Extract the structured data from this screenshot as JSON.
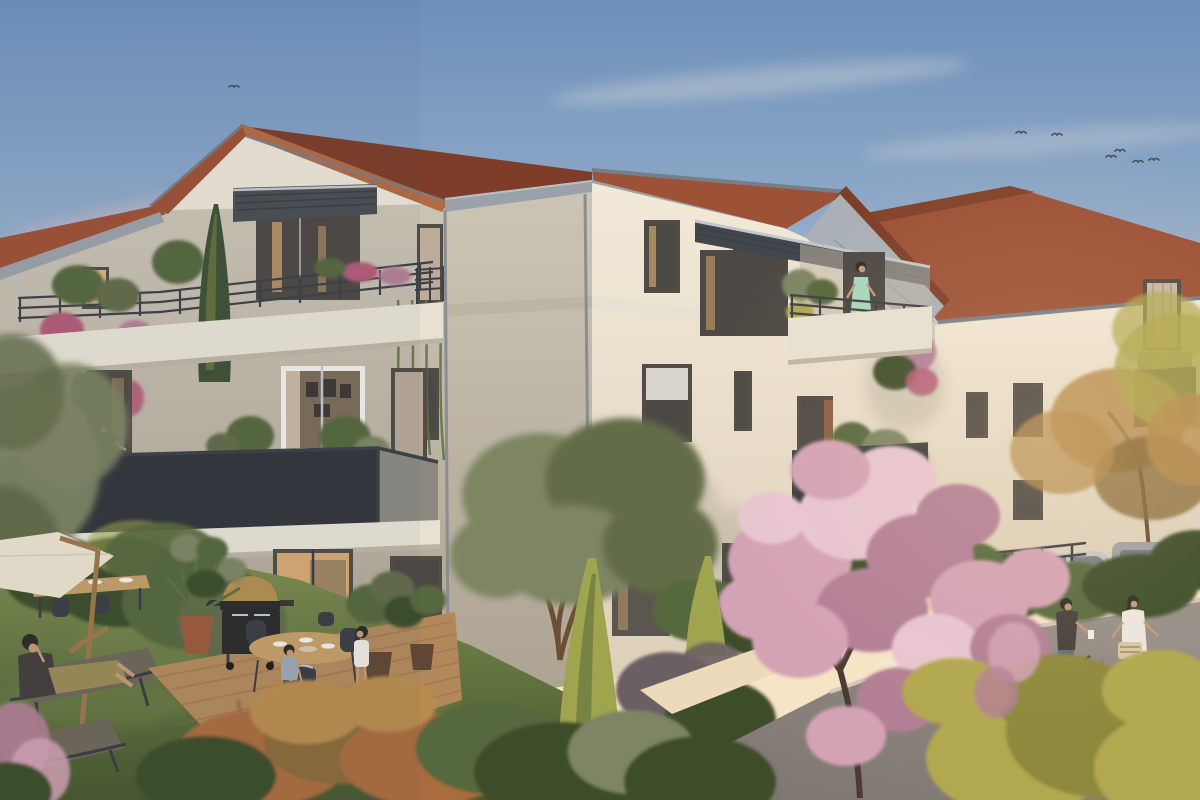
{
  "image": {
    "kind": "photorealistic architectural exterior rendering",
    "time_of_day": "dusk",
    "width_px": 1200,
    "height_px": 800
  },
  "palette": {
    "skyTop": "#6c90ba",
    "skyUpper": "#8fa9c7",
    "skyMid": "#bcc4ce",
    "skyLow": "#ead6c2",
    "skyHorizon": "#f7e3c6",
    "glowWarm": "#f8ddb0",
    "cloudPink": "#d8b9bd",
    "cloudWhite": "#e9e2dd",
    "birdGray": "#4a4f55",
    "roofTile": "#9d5136",
    "roofTileLight": "#b26a42",
    "roofTileDark": "#7d3d28",
    "fascia": "#9ba1a8",
    "fasciaDark": "#787e86",
    "soffit": "#a9b0b6",
    "alu": "#c2c7cc",
    "gableWhite": "#ebe4d5",
    "facadeFront": "#cfc8b9",
    "facadeFrontDark": "#ada392",
    "facadeSun": "#f2e9d8",
    "facadeSunLow": "#ddd0ba",
    "slab": "#e7e1d3",
    "slabShadow": "#bdb5a4",
    "railDark": "#3d4045",
    "mesh": "#33363a",
    "meshSun": "#8b8880",
    "winFrame": "#504c46",
    "glassCool": "#b0bac0",
    "glassDark": "#4c4843",
    "glassWarm": "#e3b276",
    "glassInterior": "#7c6c58",
    "curtain": "#c9b7a2",
    "shutter": "#8a6040",
    "grassLight": "#7d8e4f",
    "grassDark": "#47572e",
    "hedge": "#56673c",
    "hedgeDark": "#3e4d2b",
    "olive": "#7d8562",
    "oliveDark": "#636c49",
    "purpleShrub": "#6b5f63",
    "cypress": "#3f5234",
    "cypressGold": "#9fa44e",
    "blossom": "#d4a2b5",
    "blossomLight": "#e8c5d1",
    "blossomDark": "#b37f96",
    "blossomTrunk": "#4b3b33",
    "bougainvillea": "#b25c78",
    "goldenBush": "#b2a850",
    "goldenDark": "#8e893d",
    "autumn": "#b78c4d",
    "autumnDark": "#8a6a38",
    "orangeShrub": "#a96c3e",
    "deckWood": "#b2885a",
    "deckDark": "#8f6c42",
    "tableWood": "#c49e68",
    "road": "#968e88",
    "roadDark": "#7b746e",
    "curb": "#d2c9ba",
    "pathWarm": "#ecdabb",
    "lineWhite": "#eceae3",
    "carSilver": "#c6c6c7",
    "carGray": "#9da1a4",
    "carDark": "#686c70",
    "bikeRed": "#c23a33",
    "bikeDark": "#393c40",
    "basket": "#d8c8a6",
    "parasol": "#eae1cd",
    "woodPole": "#9c7749",
    "skin": "#c69876",
    "hairDark": "#2e2a27",
    "dressMint": "#a6d7bf",
    "outfitOlive": "#9a8a55",
    "jacketDark": "#433f3b",
    "shirtBoy": "#9aa8b2",
    "topWhite": "#ece7e0",
    "jeans": "#5a6b80",
    "pantsBeige": "#c9b8a2",
    "loungeFabric": "#6e6758",
    "bbqBlack": "#2e2c2a",
    "bbqBrass": "#b28f4e",
    "potTerracotta": "#9c5a3c",
    "potDark": "#5f4734"
  },
  "scene": {
    "sky": {
      "bird_count": 7,
      "clouds": "soft pink and white wisps near the horizon"
    },
    "buildings": {
      "main_residence": {
        "storeys": 3,
        "roof": "terracotta tiles with grey fascia and soffit boards",
        "walls": "cream render",
        "balconies": [
          "attic terrace with slatted pergola and bar railing",
          "second-floor balcony with dark perforated mesh railing",
          "sunlit corner balcony with bar railing and flower boxes",
          "street-side mesh balcony"
        ],
        "features": [
          "slatted brise-soleil",
          "downspouts",
          "hanging bougainvillea",
          "timber deck terrace"
        ]
      },
      "background_residence": {
        "roof": "terracotta tiles",
        "walls": "cream render",
        "features": [
          "curtained window",
          "recessed mesh balcony"
        ]
      }
    },
    "people": [
      {
        "label": "woman reclining on garden lounger"
      },
      {
        "label": "woman seated at second-floor balcony table"
      },
      {
        "label": "woman in mint dress on corner balcony"
      },
      {
        "label": "boy carrying a bucket across the deck"
      },
      {
        "label": "girl standing by the outdoor dining table"
      },
      {
        "label": "man standing with dark bicycle on the road"
      },
      {
        "label": "woman with red bicycle and wicker basket"
      }
    ],
    "garden": {
      "items": [
        "cantilever parasol",
        "garden dining table with place settings",
        "two sun loungers",
        "barbecue grill with brass lid",
        "potted fan palm",
        "leafy potted plants",
        "oval deck dining table with four chairs"
      ]
    },
    "street": {
      "surface": "asphalt",
      "markings": "white dashed centre line",
      "furniture": [
        "low rail fence",
        "hedges"
      ],
      "vehicles": [
        "silver parked car",
        "grey parked car"
      ]
    },
    "vegetation": [
      "pink flowering tree",
      "olive tree",
      "golden cypress cones",
      "dark cypress",
      "autumn tree",
      "golden shrubs",
      "orange dry shrubs",
      "lawn"
    ]
  }
}
